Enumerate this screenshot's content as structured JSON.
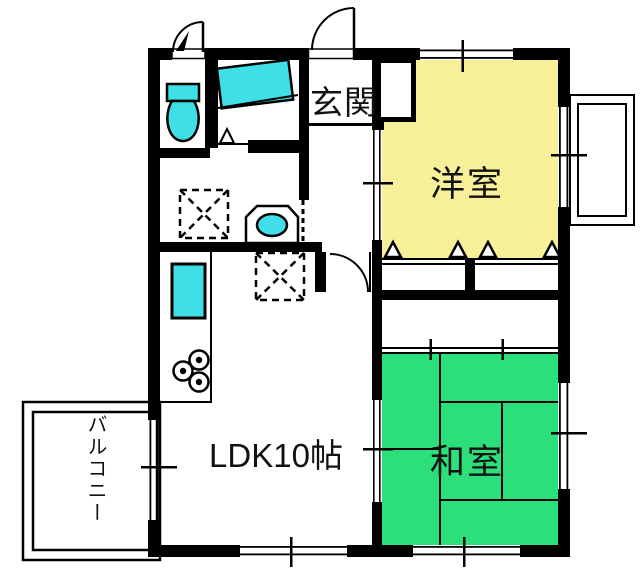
{
  "plan": {
    "title": "apartment floor plan",
    "rooms": {
      "genkan": "玄関",
      "western_room": "洋室",
      "japanese_room": "和室",
      "ldk": "LDK10帖",
      "balcony": "バルコニー"
    },
    "colors": {
      "western_room_fill": "#F7F099",
      "japanese_room_fill": "#2BDF7B",
      "fixture_fill": "#3FDFE8",
      "wall": "#000000",
      "background": "#FFFFFF"
    },
    "fixtures": {
      "toilet": "toilet",
      "bathtub": "bathtub",
      "washbasin": "washbasin",
      "kitchen_sink": "kitchen-sink",
      "stove": "stove-burners",
      "washing_machine_space": "washing-machine-space",
      "refrigerator_space": "refrigerator-space"
    }
  }
}
